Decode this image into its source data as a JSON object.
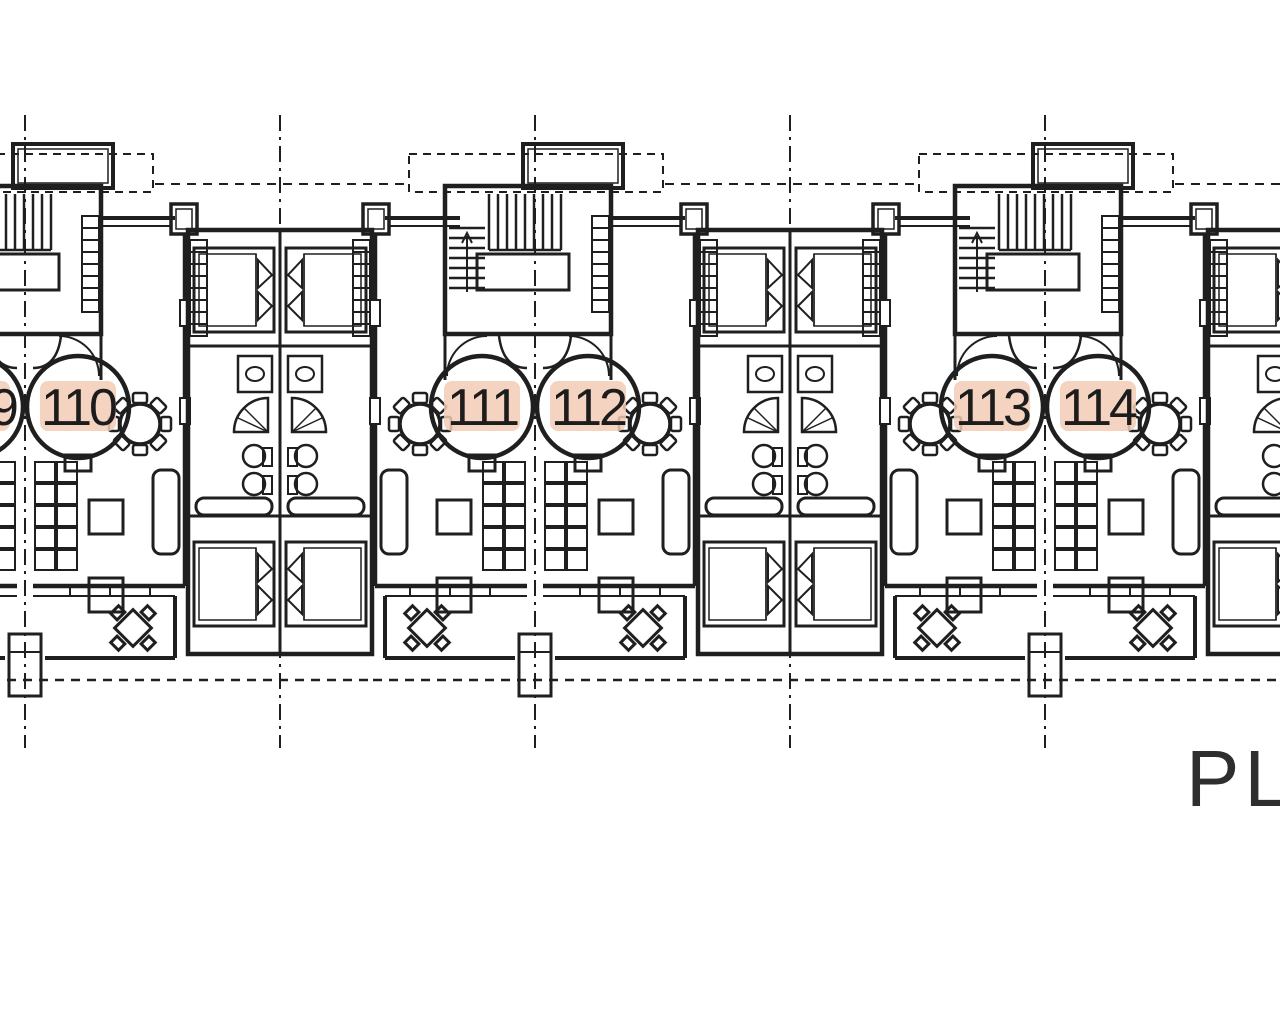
{
  "meta": {
    "type": "architectural-floor-plan-scan",
    "background": "#ffffff",
    "ink": "#1f1f1f",
    "highlight": "#f2cbb5",
    "highlight_light": "#f7dccb"
  },
  "plan_label": {
    "text": "PLA"
  },
  "units": [
    {
      "label": "9"
    },
    {
      "label": "110"
    },
    {
      "label": "111"
    },
    {
      "label": "112"
    },
    {
      "label": "113"
    },
    {
      "label": "114"
    }
  ],
  "symbols": [
    "staircase-icon",
    "double-bed-icon",
    "round-dining-table-icon",
    "terrace-table-icon",
    "toilet-icon",
    "sink-icon",
    "shower-icon",
    "centerline-icon"
  ]
}
